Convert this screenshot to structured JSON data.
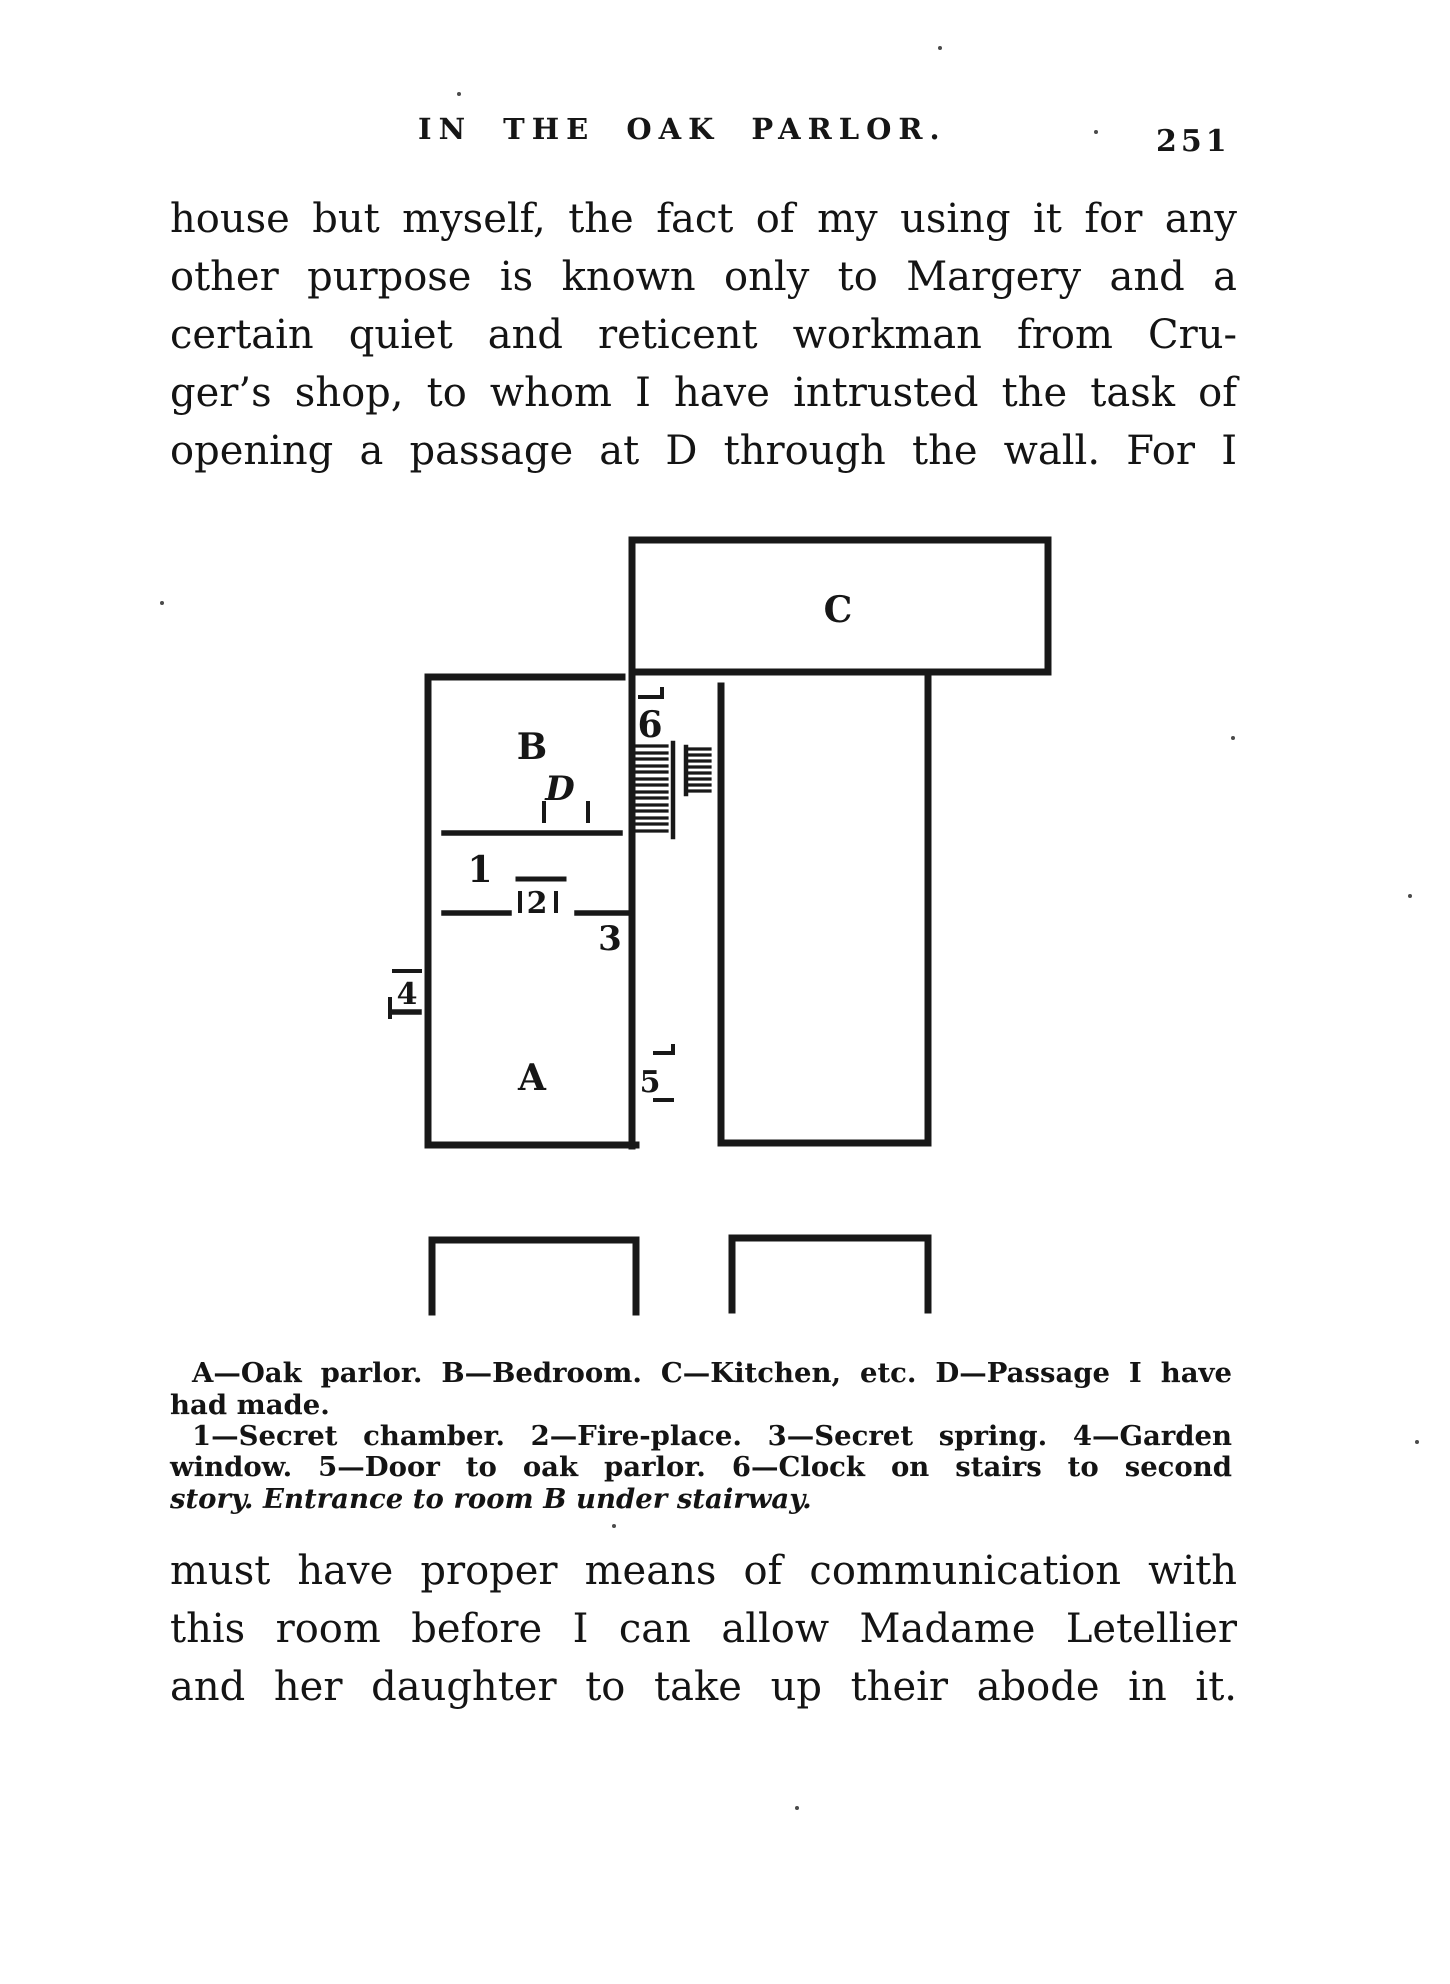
{
  "colors": {
    "ink": "#161616",
    "paper": "#ffffff"
  },
  "header": {
    "title": "IN THE OAK PARLOR.",
    "page_number": "251"
  },
  "paragraph_top": {
    "lines": [
      "house but myself, the fact of my using it for any",
      "other purpose is known only to Margery and a",
      "certain quiet and reticent workman from Cru-",
      "ger’s shop, to whom I have intrusted the task of",
      "opening a passage at D through the wall. For I"
    ]
  },
  "diagram": {
    "labels": {
      "A": "A",
      "B": "B",
      "C": "C",
      "D": "D",
      "n1": "1",
      "n2": "2",
      "n3": "3",
      "n4": "4",
      "n5": "5",
      "n6": "6"
    }
  },
  "caption": {
    "lines": [
      "A—Oak parlor. B—Bedroom. C—Kitchen, etc. D—Passage I have",
      "had made.",
      "1—Secret chamber. 2—Fire-place. 3—Secret spring. 4—Garden",
      "window. 5—Door to oak parlor. 6—Clock on stairs to second",
      "story. Entrance to room B under stairway."
    ]
  },
  "paragraph_bottom": {
    "lines": [
      "must have proper means of communication with",
      "this room before I can allow Madame Letellier",
      "and her daughter to take up their abode in it."
    ]
  }
}
